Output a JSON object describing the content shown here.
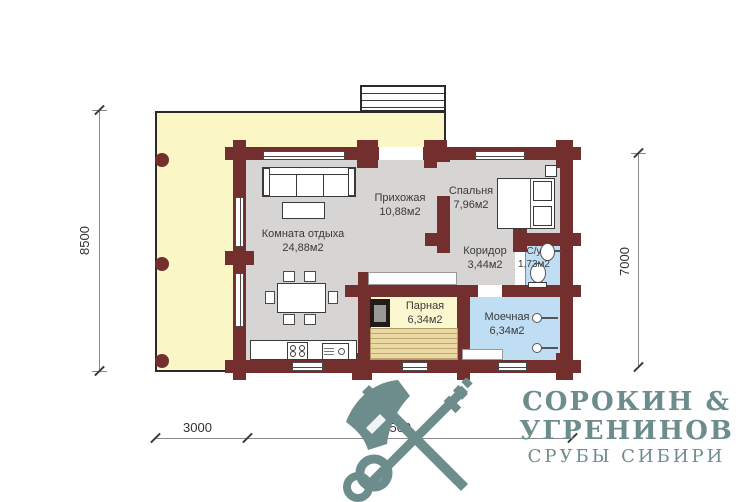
{
  "rooms": [
    {
      "id": "komnata-otdyha",
      "label": "Комната отдыха",
      "area": "24,88м2"
    },
    {
      "id": "prihozhaya",
      "label": "Прихожая",
      "area": "10,88м2"
    },
    {
      "id": "spalnya",
      "label": "Спальня",
      "area": "7,96м2"
    },
    {
      "id": "koridor",
      "label": "Коридор",
      "area": "3,44м2"
    },
    {
      "id": "su",
      "label": "С/у",
      "area": "1,73м2"
    },
    {
      "id": "parnaya",
      "label": "Парная",
      "area": "6,34м2"
    },
    {
      "id": "moechnaya",
      "label": "Моечная",
      "area": "6,34м2"
    }
  ],
  "dimensions": {
    "left_total": "8500",
    "right_house": "7000",
    "bottom_terrace": "3000",
    "bottom_house": "10500"
  },
  "logo": {
    "line1": "СОРОКИН &",
    "line2": "УГРЕНИНОВ",
    "line3": "СРУБЫ СИБИРИ",
    "icon": "crossed-axe-and-key-icon"
  },
  "colors": {
    "wall": "#722f2d",
    "terrace_floor": "#faf6c6",
    "room_floor": "#d6d5d3",
    "wet_room_floor": "#bfdef4",
    "sauna_floor": "#fbf8cf",
    "logo": "#6d8d8c"
  }
}
